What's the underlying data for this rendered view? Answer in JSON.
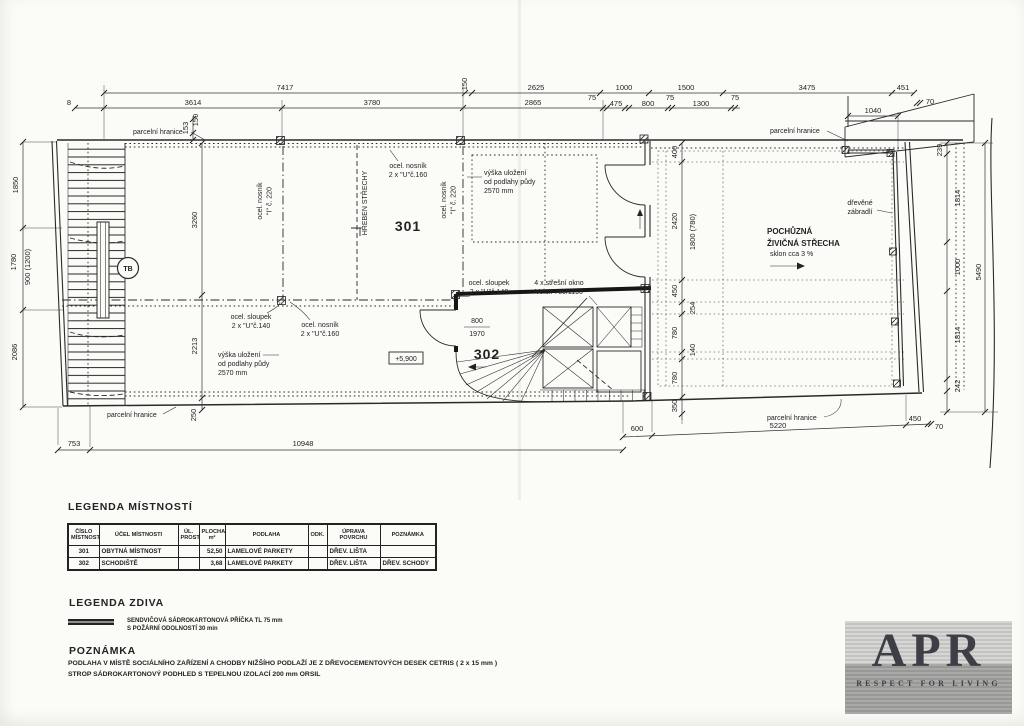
{
  "dims": {
    "top_row1": [
      "7417",
      "150",
      "2625",
      "1000",
      "1500",
      "3475",
      "451"
    ],
    "top_row2": [
      "8",
      "3614",
      "3780",
      "2865",
      "75",
      "475",
      "800",
      "75",
      "1300",
      "75",
      "1040",
      "70"
    ],
    "left": [
      "1850",
      "1780",
      "900 (1200)",
      "2086"
    ],
    "left_small": [
      "153",
      "150"
    ],
    "center": [
      "3260",
      "2213",
      "250"
    ],
    "terrace": [
      "400",
      "2420",
      "450",
      "780",
      "780",
      "350"
    ],
    "terrace_inner": [
      "1800 (780)",
      "254",
      "140"
    ],
    "right": [
      "239",
      "1814",
      "1000",
      "1814",
      "242"
    ],
    "right_total": "5490",
    "bottom": [
      "753",
      "10948",
      "600",
      "5220",
      "450",
      "70"
    ]
  },
  "plan": {
    "room_301": "301",
    "room_302": "302",
    "parcel_boundary": "parcelní hranice",
    "ridge": "HŘEBEN STŘECHY",
    "beam_u160_line1": "ocel. nosník",
    "beam_u160_line2": "2 x \"U\"č.160",
    "beam_i220_line1": "ocel. nosník",
    "beam_i220_line2": "\"I\" č. 220",
    "column_line1": "ocel. sloupek",
    "column_line2": "2 x \"U\"č.140",
    "attic_line1": "výška uložení",
    "attic_line2": "od podlahy půdy",
    "attic_line3": "2570 mm",
    "skylight_line1": "4 x střešní okno",
    "skylight_line2": "Velux 780/1190",
    "terrace_line1": "POCHŮZNÁ",
    "terrace_line2": "ŽIVIČNÁ STŘECHA",
    "terrace_line3": "sklon cca 3 %",
    "railing_line1": "dřevěné",
    "railing_line2": "zábradlí",
    "door_width": "800",
    "door_height": "1970",
    "elevation": "+5,900",
    "survey_point": "TB"
  },
  "legend_rooms": {
    "title": "LEGENDA MÍSTNOSTÍ",
    "headers": [
      "ČÍSLO MÍSTNOSTI",
      "ÚČEL MÍSTNOSTI",
      "ÚL. PROST.",
      "PLOCHA m²",
      "PODLAHA",
      "ODK.",
      "ÚPRAVA POVRCHU",
      "POZNÁMKA"
    ],
    "rows": [
      [
        "301",
        "OBYTNÁ MÍSTNOST",
        "",
        "52,50",
        "LAMELOVÉ PARKETY",
        "",
        "DŘEV. LIŠTA",
        ""
      ],
      [
        "302",
        "SCHODIŠTĚ",
        "",
        "3,68",
        "LAMELOVÉ PARKETY",
        "",
        "DŘEV. LIŠTA",
        "DŘEV. SCHODY"
      ]
    ]
  },
  "legend_walls": {
    "title": "LEGENDA ZDIVA",
    "item_line1": "SENDVIČOVÁ SÁDROKARTONOVÁ PŘÍČKA TL 75 mm",
    "item_line2": "S POŽÁRNÍ ODOLNOSTÍ 30 min"
  },
  "note": {
    "title": "POZNÁMKA",
    "line1": "PODLAHA V MÍSTĚ SOCIÁLNÍHO ZAŘÍZENÍ A CHODBY NIŽŠÍHO PODLAŽÍ JE Z DŘEVOCEMENTOVÝCH DESEK CETRIS ( 2 x 15 mm )",
    "line2": "STROP SÁDROKARTONOVÝ PODHLED S TEPELNOU IZOLACÍ 200 mm ORSIL"
  },
  "logo": {
    "name": "APR",
    "tagline": "RESPECT FOR LIVING"
  },
  "colors": {
    "ink": "#232323",
    "paper": "#fbfbf8",
    "logo_text": "#3e3e47"
  }
}
